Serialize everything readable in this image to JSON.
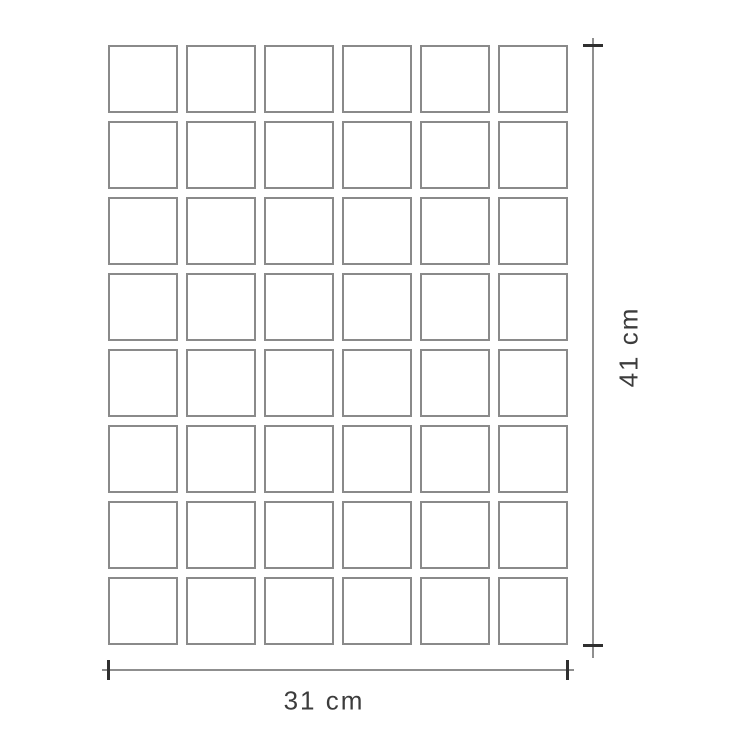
{
  "diagram": {
    "type": "product-dimension-diagram",
    "grid": {
      "columns": 6,
      "rows": 8,
      "tile_count": 48,
      "tile_shape": "square"
    },
    "dimensions": {
      "height_label": "41 cm",
      "width_label": "31 cm"
    },
    "colors": {
      "background": "#ffffff",
      "tile_border": "#8a8a8a",
      "dimension_line": "#8f8f8f",
      "tick": "#2f2f2f",
      "label_text": "#3c3c3c"
    }
  }
}
